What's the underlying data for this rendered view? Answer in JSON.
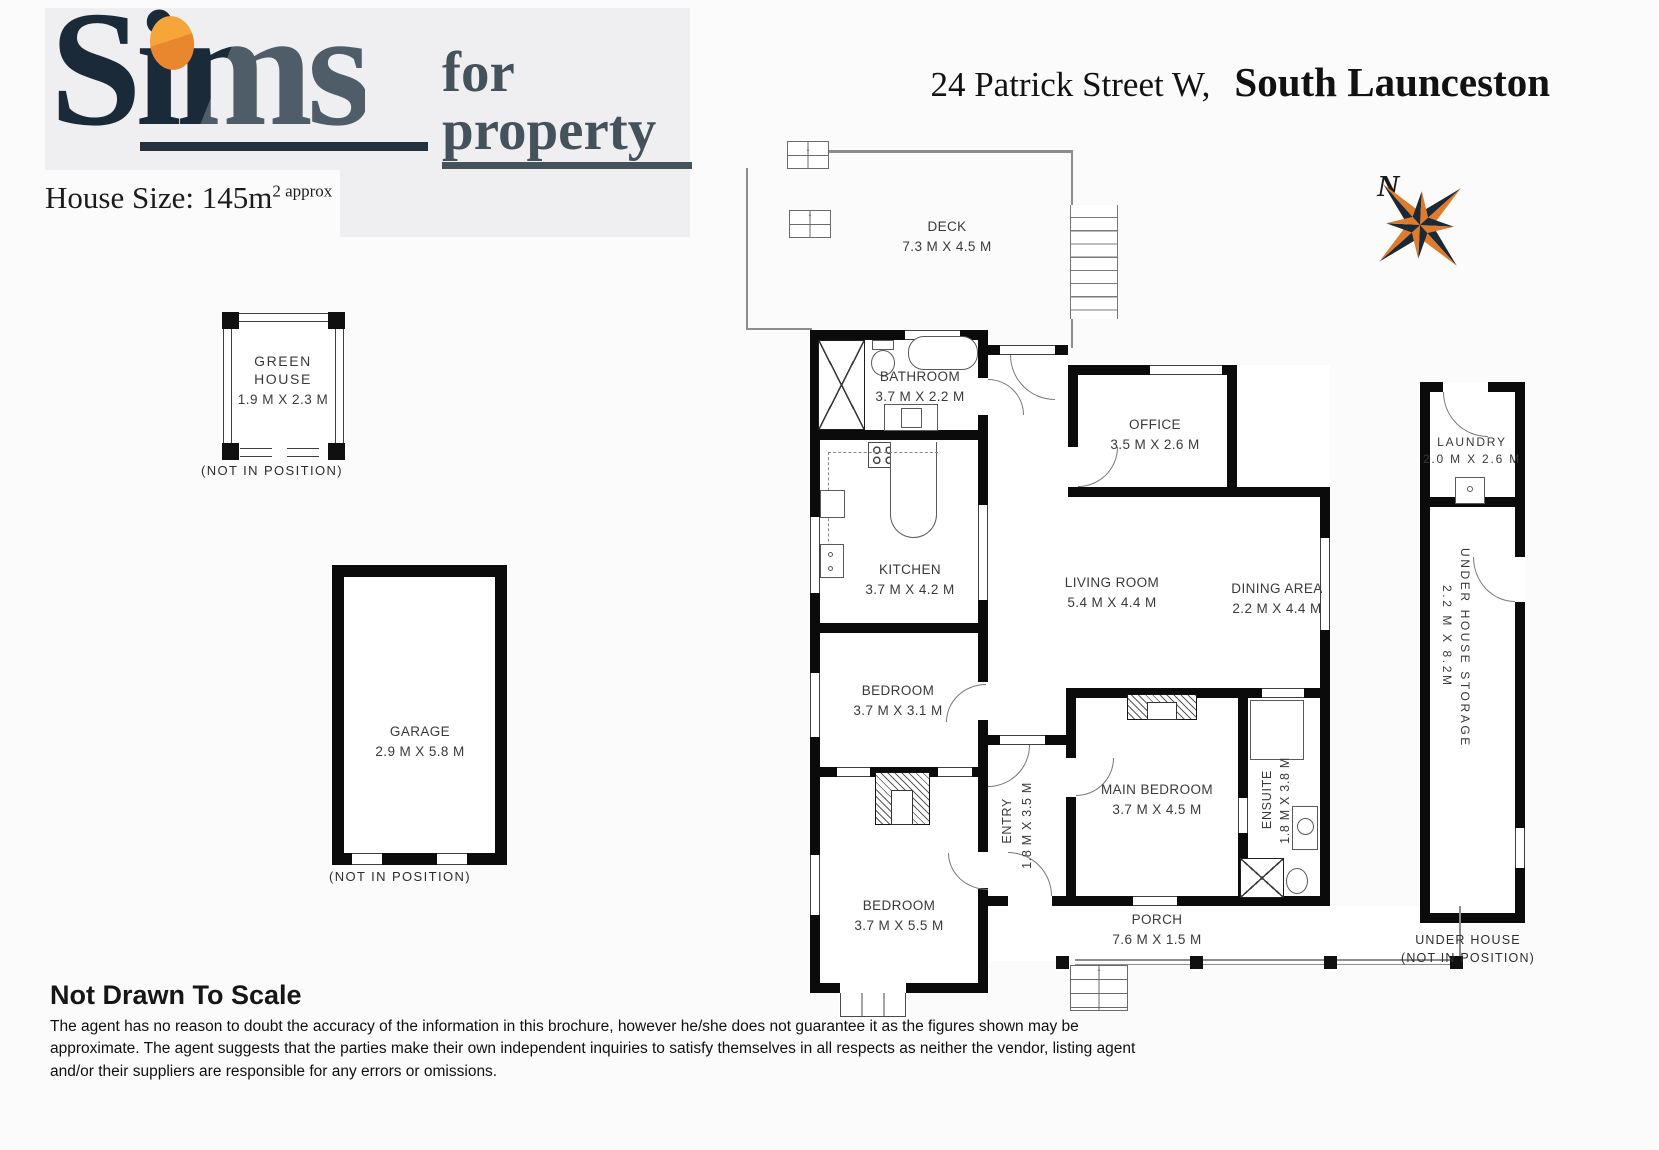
{
  "header": {
    "logo": {
      "word_main": "Sims",
      "word_for": "for",
      "word_property": "property"
    },
    "house_size": {
      "label": "House Size: 145m",
      "sup": "2 approx"
    },
    "address": {
      "street": "24 Patrick Street W,",
      "suburb": "South Launceston"
    },
    "compass": {
      "north": "N"
    }
  },
  "plan": {
    "rooms": {
      "deck": {
        "name": "DECK",
        "dims": "7.3 M X 4.5 M"
      },
      "bathroom": {
        "name": "BATHROOM",
        "dims": "3.7 M X 2.2 M"
      },
      "office": {
        "name": "OFFICE",
        "dims": "3.5 M X 2.6 M"
      },
      "kitchen": {
        "name": "KITCHEN",
        "dims": "3.7 M X 4.2 M"
      },
      "living_room": {
        "name": "LIVING ROOM",
        "dims": "5.4 M X 4.4 M"
      },
      "dining_area": {
        "name": "DINING AREA",
        "dims": "2.2 M X 4.4 M"
      },
      "bedroom_1": {
        "name": "BEDROOM",
        "dims": "3.7 M X 3.1 M"
      },
      "entry": {
        "name": "ENTRY",
        "dims": "1.8 M X 3.5 M"
      },
      "main_bedroom": {
        "name": "MAIN BEDROOM",
        "dims": "3.7 M X 4.5 M"
      },
      "ensuite": {
        "name": "ENSUITE",
        "dims": "1.8 M X 3.8 M"
      },
      "bedroom_2": {
        "name": "BEDROOM",
        "dims": "3.7 M X 5.5 M"
      },
      "porch": {
        "name": "PORCH",
        "dims": "7.6 M X 1.5 M"
      },
      "laundry": {
        "name": "LAUNDRY",
        "dims": "2.0 M X 2.6 M"
      },
      "under_house_storage": {
        "name": "UNDER HOUSE STORAGE",
        "dims": "2.2 M X 8.2M"
      }
    },
    "outbuildings": {
      "greenhouse": {
        "name_line1": "GREEN",
        "name_line2": "HOUSE",
        "dims": "1.9 M X 2.3 M",
        "caption": "(NOT IN POSITION)"
      },
      "garage": {
        "name": "GARAGE",
        "dims": "2.9 M X 5.8 M",
        "caption": "(NOT IN POSITION)"
      },
      "under_house": {
        "caption_line1": "UNDER HOUSE",
        "caption_line2": "(NOT IN POSITION)"
      }
    },
    "icons": {
      "arrow_up": "↑",
      "arrow_down": "↓"
    }
  },
  "footer": {
    "title": "Not Drawn To Scale",
    "disclaimer": "The agent has no reason to doubt the accuracy of the information in this brochure, however he/she does not guarantee it as the figures shown may be approximate. The agent suggests that the parties make their own independent inquiries to satisfy themselves in all respects as neither the vendor, listing agent and/or their suppliers are responsible for any errors or omissions."
  },
  "colors": {
    "accent_orange": "#E8872E",
    "logo_navy": "#1B2A38",
    "logo_slate": "#4E5D68",
    "wall_black": "#0B0B0B"
  }
}
